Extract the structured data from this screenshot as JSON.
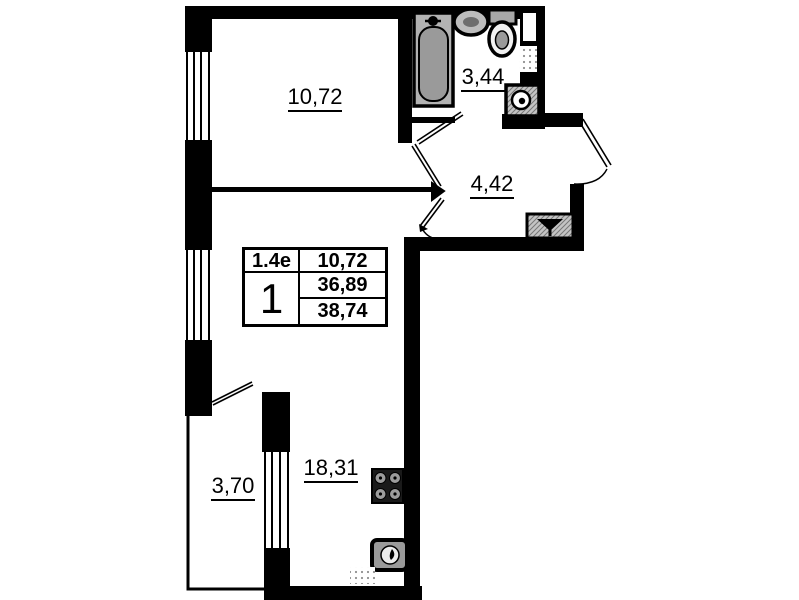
{
  "floorplan": {
    "unit": {
      "type_code": "1.4e",
      "room_count": "1",
      "first_room_area": "10,72",
      "living_area": "36,89",
      "total_area": "38,74"
    },
    "labels": {
      "bedroom": "10,72",
      "bathroom": "3,44",
      "hallway": "4,42",
      "kitchen_living": "18,31",
      "balcony": "3,70"
    },
    "colors": {
      "wall": "#000000",
      "background": "#ffffff",
      "fixture_gray": "#a3a3a3",
      "hatch_gray": "#c4c4c4",
      "dot_gray": "#8f8f8f"
    }
  }
}
